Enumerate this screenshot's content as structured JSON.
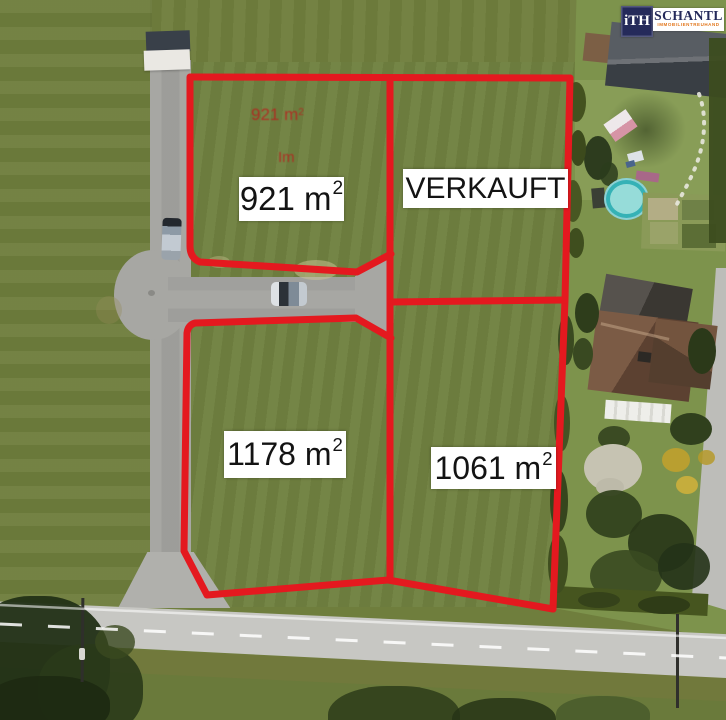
{
  "branding": {
    "logo_mark": "iTH",
    "company_name": "SCHANTL",
    "company_subtitle": "IMMOBILIENTREUHAND"
  },
  "plots": {
    "top_left": {
      "area": "921 m",
      "sup": "2"
    },
    "top_right": {
      "status": "VERKAUFT"
    },
    "bottom_left": {
      "area": "1178 m",
      "sup": "2"
    },
    "bottom_right": {
      "area": "1061 m",
      "sup": "2"
    }
  },
  "faint_annotations": {
    "area": "921 m",
    "sup": "2",
    "note": "Im"
  },
  "colors": {
    "boundary_red": "#e4191f",
    "field_green": "#6f7e3d",
    "garden_green": "#7d934c",
    "access_road_gray": "#a7a7a3",
    "main_road_gray": "#c7c7c3",
    "label_background": "#ffffff",
    "label_text": "#131313",
    "logo_navy": "#252a5a",
    "logo_orange": "#e2761b",
    "pool_turquoise": "#35b2b6",
    "faint_annotation_red": "#bb1c1c"
  }
}
